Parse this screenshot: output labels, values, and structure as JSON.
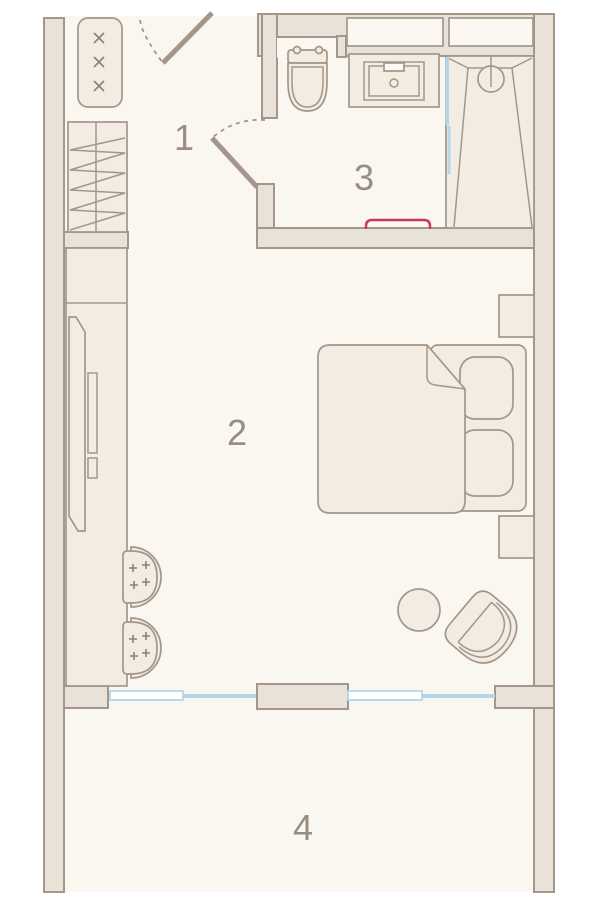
{
  "floorplan": {
    "rooms": [
      {
        "label": "1"
      },
      {
        "label": "2"
      },
      {
        "label": "3"
      },
      {
        "label": "4"
      }
    ],
    "colors": {
      "background": "#ffffff",
      "floor_fill": "#faf6f0",
      "wall_fill": "#e9e2d9",
      "wall_stroke": "#a49689",
      "furniture_fill": "#f2ece3",
      "light_fill": "#fbf8f3",
      "glass_blue": "#b3d7e9",
      "towel_rail_red": "#c63a62",
      "label_color": "#9a8d80",
      "detail_stroke": "#8d8075"
    },
    "symbols": [
      "entrance-door",
      "interior-door",
      "radiator",
      "entry-wardrobe",
      "tall-cabinet",
      "tv-panel",
      "desk-chair",
      "toilet",
      "sink-vanity",
      "shower",
      "shower-head",
      "glass-partition",
      "towel-rail",
      "double-bed",
      "pillow",
      "blanket",
      "nightstand",
      "side-table",
      "armchair",
      "window-glazing",
      "sliding-panel",
      "ventilation-shaft"
    ]
  }
}
